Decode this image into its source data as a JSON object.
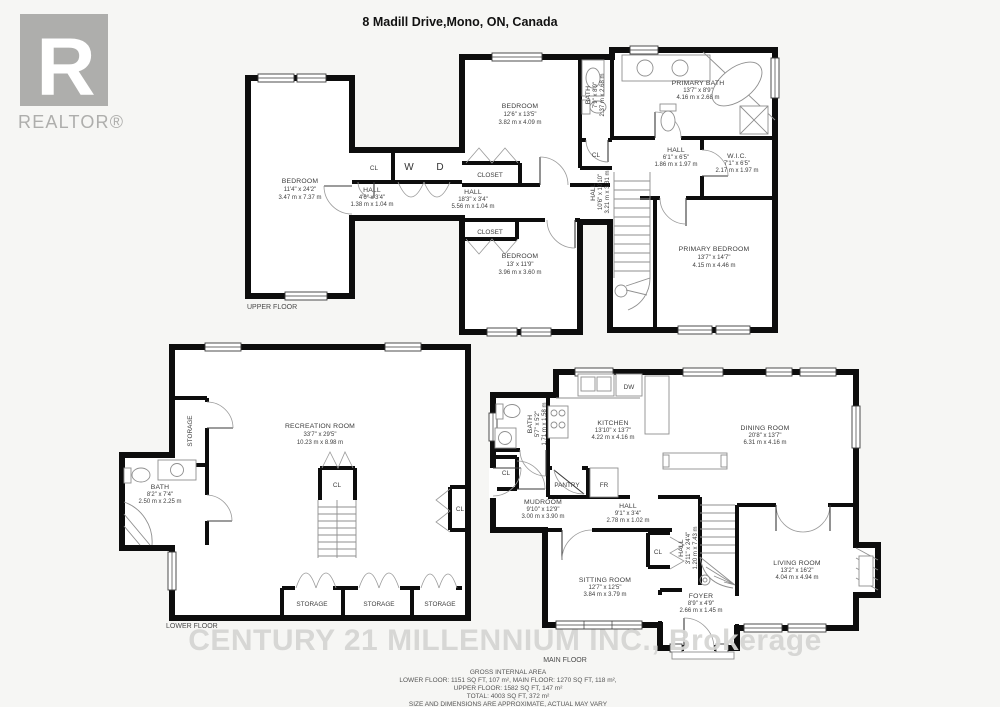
{
  "title": "8 Madill Drive,Mono, ON, Canada",
  "logo": {
    "r": "R",
    "label": "REALTOR®"
  },
  "watermark": "CENTURY 21 MILLENNIUM INC., Brokerage",
  "colors": {
    "wall": "#0d0d0d",
    "background": "#f6f6f4",
    "watermark": "#d6d6d4",
    "logo_gray": "#aeaeac"
  },
  "upper": {
    "floor_label": "UPPER FLOOR",
    "bedroom_left": {
      "name": "BEDROOM",
      "ft": "11'4\" x 24'2\"",
      "m": "3.47 m x 7.37 m"
    },
    "cl1": "CL",
    "washer": "W",
    "dryer": "D",
    "hall_small": {
      "name": "HALL",
      "ft": "4'6\" x 3'4\"",
      "m": "1.38 m x 1.04 m"
    },
    "bedroom_top": {
      "name": "BEDROOM",
      "ft": "12'6\" x 13'5\"",
      "m": "3.82 m x 4.09 m"
    },
    "closet_top": "CLOSET",
    "hall_main": {
      "name": "HALL",
      "ft": "18'3\" x 3'4\"",
      "m": "5.56 m x 1.04 m"
    },
    "closet_bottom": "CLOSET",
    "bedroom_bottom": {
      "name": "BEDROOM",
      "ft": "13' x 11'9\"",
      "m": "3.96 m x 3.60 m"
    },
    "bath": {
      "name": "BATH",
      "ft": "7'9\" x 8'9\"",
      "m": "2.37 m x 2.68 m"
    },
    "cl2": "CL",
    "primary_bath": {
      "name": "PRIMARY BATH",
      "ft": "13'7\" x 8'9\"",
      "m": "4.16 m x 2.68 m"
    },
    "hall_upper": {
      "name": "HALL",
      "ft": "6'1\" x 6'5\"",
      "m": "1.86 m x 1.97 m"
    },
    "wic": {
      "name": "W.I.C.",
      "ft": "7'1\" x 6'5\"",
      "m": "2.17 m x 1.97 m"
    },
    "hall_stairs": {
      "name": "HALL",
      "ft": "10'6\" x 10'10\"",
      "m": "3.21 m x 3.31 m"
    },
    "primary_bedroom": {
      "name": "PRIMARY BEDROOM",
      "ft": "13'7\" x 14'7\"",
      "m": "4.15 m x 4.46 m"
    }
  },
  "lower": {
    "floor_label": "LOWER FLOOR",
    "storage_side": "STORAGE",
    "bath": {
      "name": "BATH",
      "ft": "8'2\" x 7'4\"",
      "m": "2.50 m x 2.25 m"
    },
    "recreation": {
      "name": "RECREATION ROOM",
      "ft": "33'7\" x 29'5\"",
      "m": "10.23 m x 8.98 m"
    },
    "cl": "CL",
    "cl_right": "CL",
    "storage1": "STORAGE",
    "storage2": "STORAGE",
    "storage3": "STORAGE"
  },
  "main": {
    "floor_label": "MAIN FLOOR",
    "kitchen": {
      "name": "KITCHEN",
      "ft": "13'10\" x 13'7\"",
      "m": "4.22 m x 4.16 m"
    },
    "dw": "DW",
    "dining": {
      "name": "DINING ROOM",
      "ft": "20'8\" x 13'7\"",
      "m": "6.31 m x 4.16 m"
    },
    "bath": {
      "name": "BATH",
      "ft": "5'7\" x 5'2\"",
      "m": "1.71 m x 1.58 m"
    },
    "cl_left": "CL",
    "pantry": "PANTRY",
    "fr": "FR",
    "mudroom": {
      "name": "MUDROOM",
      "ft": "9'10\" x 12'9\"",
      "m": "3.00 m x 3.90 m"
    },
    "hall": {
      "name": "HALL",
      "ft": "9'1\" x 3'4\"",
      "m": "2.78 m x 1.02 m"
    },
    "cl_sitting": "CL",
    "hall_vertical": {
      "name": "HALL",
      "ft": "3'11\" x 24'4\"",
      "m": "1.20 m x 7.43 m"
    },
    "sitting": {
      "name": "SITTING ROOM",
      "ft": "12'7\" x 12'5\"",
      "m": "3.84 m x 3.79 m"
    },
    "foyer": {
      "name": "FOYER",
      "ft": "8'9\" x 4'9\"",
      "m": "2.66 m x 1.45 m"
    },
    "living": {
      "name": "LIVING ROOM",
      "ft": "13'2\" x 16'2\"",
      "m": "4.04 m x 4.94 m"
    }
  },
  "footer": {
    "heading": "GROSS INTERNAL AREA",
    "line1": "LOWER FLOOR: 1151 SQ FT, 107 m², MAIN FLOOR: 1270 SQ FT, 118 m²,",
    "line2": "UPPER FLOOR: 1582 SQ FT, 147 m²",
    "line3": "TOTAL: 4003 SQ FT, 372 m²",
    "disclaimer": "SIZE AND DIMENSIONS ARE APPROXIMATE, ACTUAL MAY VARY"
  }
}
